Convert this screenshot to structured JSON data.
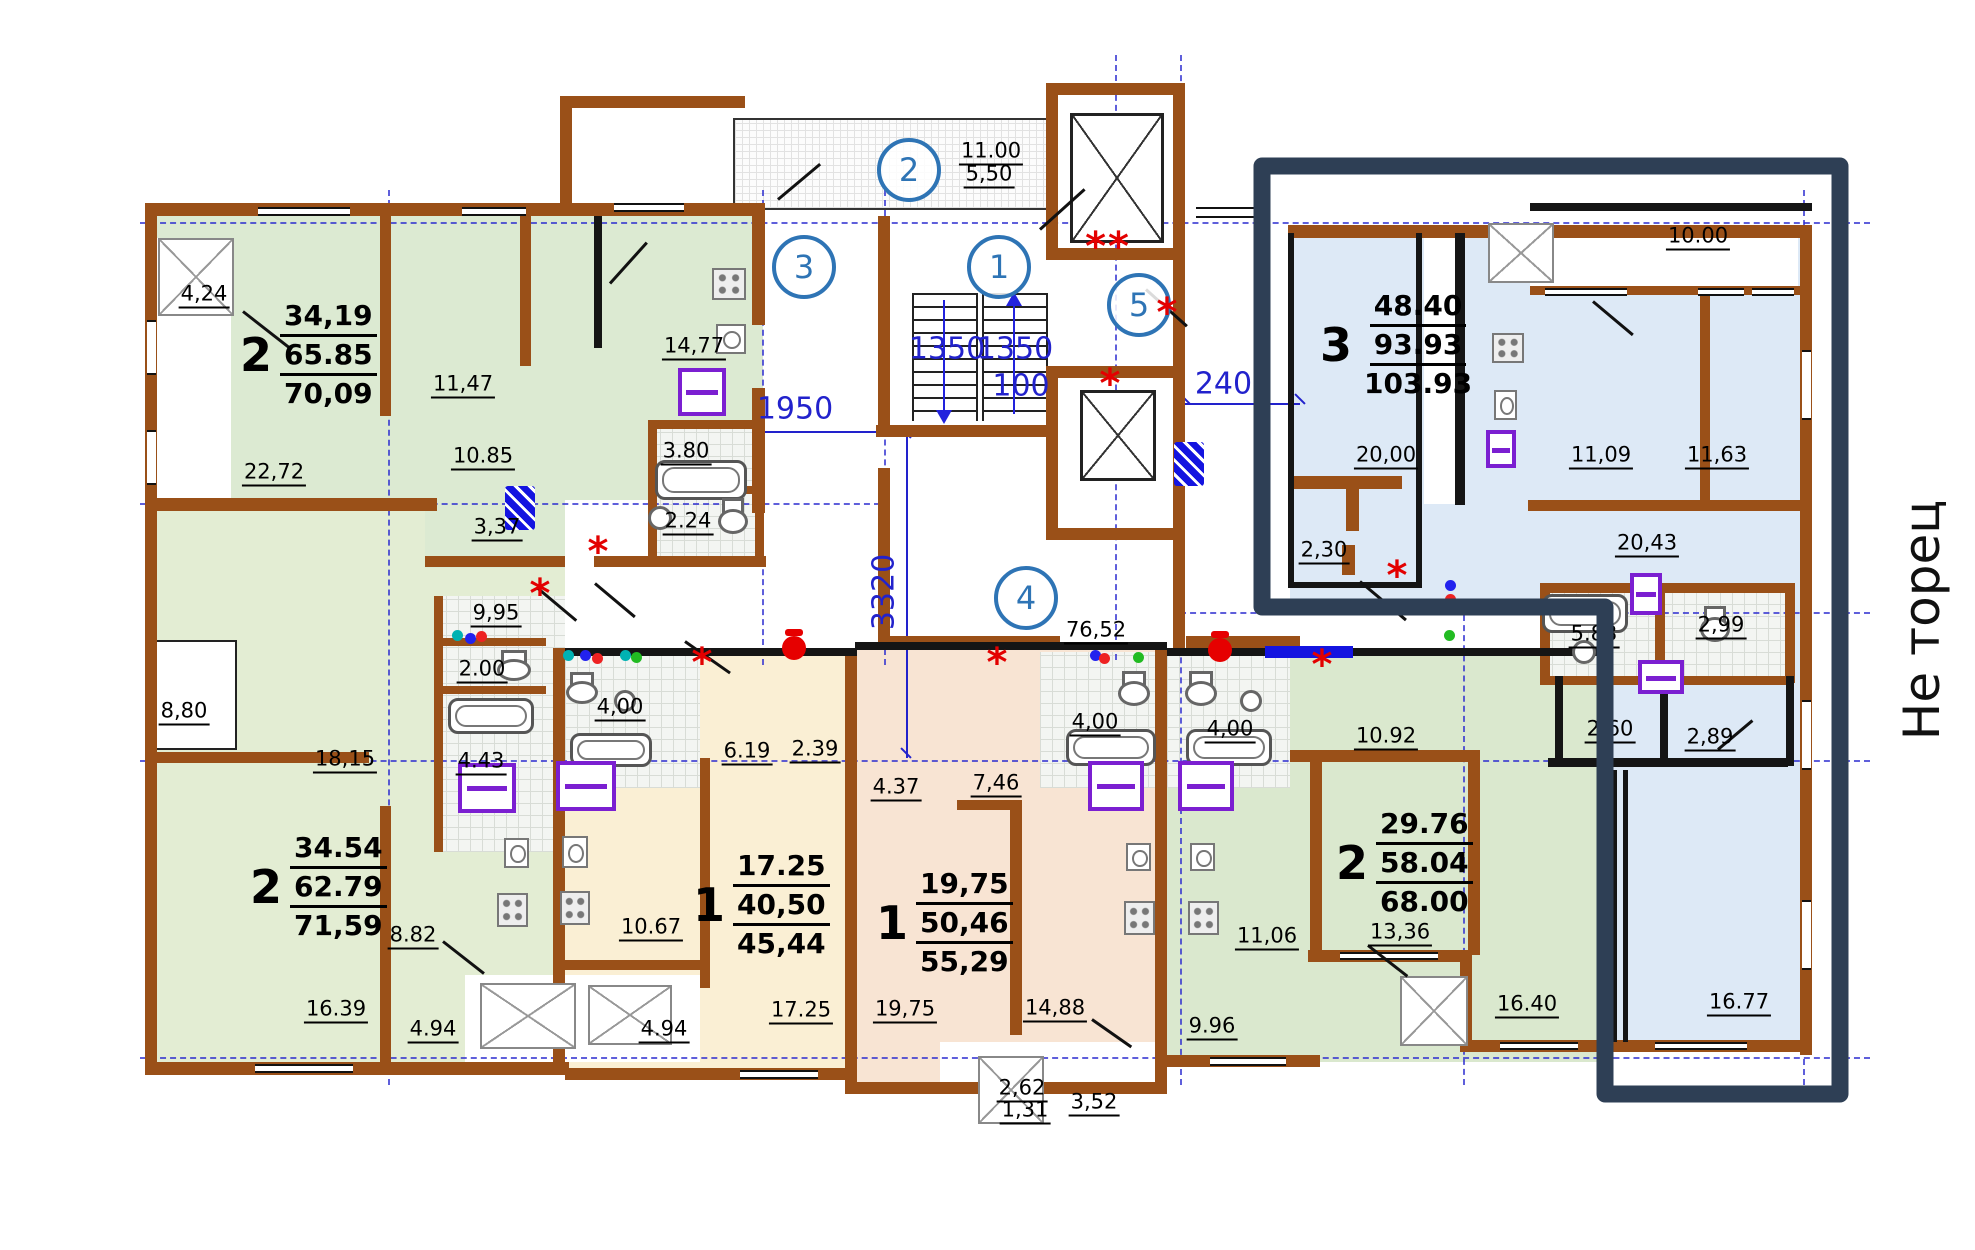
{
  "colors": {
    "wall": "#9a5018",
    "highlight": "#2e3f55",
    "dim_text": "#2222cc",
    "bubble": "#2e74b5",
    "asterisk": "#e30000"
  },
  "side_note": "Не торец",
  "axis_bubbles": [
    {
      "n": "2",
      "x": 909,
      "y": 170
    },
    {
      "n": "3",
      "x": 804,
      "y": 267
    },
    {
      "n": "1",
      "x": 999,
      "y": 267
    },
    {
      "n": "5",
      "x": 1139,
      "y": 305
    },
    {
      "n": "4",
      "x": 1026,
      "y": 598
    }
  ],
  "apartments": [
    {
      "type": "2",
      "areas": [
        "34,19",
        "65.85",
        "70,09"
      ],
      "x": 240,
      "y": 298
    },
    {
      "type": "2",
      "areas": [
        "34.54",
        "62.79",
        "71,59"
      ],
      "x": 250,
      "y": 830
    },
    {
      "type": "1",
      "areas": [
        "17.25",
        "40,50",
        "45,44"
      ],
      "x": 693,
      "y": 848
    },
    {
      "type": "1",
      "areas": [
        "19,75",
        "50,46",
        "55,29"
      ],
      "x": 876,
      "y": 866
    },
    {
      "type": "2",
      "areas": [
        "29.76",
        "58.04",
        "68.00"
      ],
      "x": 1336,
      "y": 806
    },
    {
      "type": "3",
      "areas": [
        "48.40",
        "93.93",
        "103.93"
      ],
      "x": 1320,
      "y": 288
    }
  ],
  "room_labels": [
    {
      "t": "4,24",
      "x": 204,
      "y": 295
    },
    {
      "t": "11,47",
      "x": 463,
      "y": 385
    },
    {
      "t": "22,72",
      "x": 274,
      "y": 473
    },
    {
      "t": "10.85",
      "x": 483,
      "y": 457
    },
    {
      "t": "14,77",
      "x": 694,
      "y": 347
    },
    {
      "t": "3.80",
      "x": 686,
      "y": 452
    },
    {
      "t": "2.24",
      "x": 688,
      "y": 522
    },
    {
      "t": "3,37",
      "x": 497,
      "y": 528
    },
    {
      "t": "8,80",
      "x": 184,
      "y": 712
    },
    {
      "t": "18,15",
      "x": 345,
      "y": 760
    },
    {
      "t": "9,95",
      "x": 496,
      "y": 614
    },
    {
      "t": "2.00",
      "x": 482,
      "y": 670
    },
    {
      "t": "4.43",
      "x": 481,
      "y": 762
    },
    {
      "t": "8.82",
      "x": 413,
      "y": 936
    },
    {
      "t": "16.39",
      "x": 336,
      "y": 1010
    },
    {
      "t": "4.94",
      "x": 433,
      "y": 1030
    },
    {
      "t": "4,00",
      "x": 620,
      "y": 708
    },
    {
      "t": "6.19",
      "x": 747,
      "y": 752
    },
    {
      "t": "2.39",
      "x": 815,
      "y": 750
    },
    {
      "t": "10.67",
      "x": 651,
      "y": 928
    },
    {
      "t": "17.25",
      "x": 801,
      "y": 1011
    },
    {
      "t": "4.94",
      "x": 664,
      "y": 1030
    },
    {
      "t": "4.37",
      "x": 896,
      "y": 788
    },
    {
      "t": "7,46",
      "x": 996,
      "y": 784
    },
    {
      "t": "4,00",
      "x": 1095,
      "y": 723
    },
    {
      "t": "19,75",
      "x": 905,
      "y": 1010
    },
    {
      "t": "14,88",
      "x": 1055,
      "y": 1009
    },
    {
      "t": "2,62",
      "x": 1022,
      "y": 1089
    },
    {
      "t": "1,31",
      "x": 1025,
      "y": 1111
    },
    {
      "t": "3,52",
      "x": 1094,
      "y": 1103
    },
    {
      "t": "9.96",
      "x": 1212,
      "y": 1027
    },
    {
      "t": "4,00",
      "x": 1230,
      "y": 730
    },
    {
      "t": "10.92",
      "x": 1386,
      "y": 737
    },
    {
      "t": "11,06",
      "x": 1267,
      "y": 937
    },
    {
      "t": "13,36",
      "x": 1400,
      "y": 933
    },
    {
      "t": "16.40",
      "x": 1527,
      "y": 1005
    },
    {
      "t": "20,00",
      "x": 1386,
      "y": 456
    },
    {
      "t": "2,30",
      "x": 1324,
      "y": 551
    },
    {
      "t": "11,09",
      "x": 1601,
      "y": 456
    },
    {
      "t": "11,63",
      "x": 1717,
      "y": 456
    },
    {
      "t": "20,43",
      "x": 1647,
      "y": 544
    },
    {
      "t": "5.83",
      "x": 1594,
      "y": 635
    },
    {
      "t": "2,99",
      "x": 1721,
      "y": 626
    },
    {
      "t": "2,60",
      "x": 1610,
      "y": 730
    },
    {
      "t": "2,89",
      "x": 1710,
      "y": 738
    },
    {
      "t": "16.77",
      "x": 1739,
      "y": 1003
    },
    {
      "t": "10.00",
      "x": 1698,
      "y": 237
    },
    {
      "t": "76,52",
      "x": 1096,
      "y": 631
    },
    {
      "t": "11.00",
      "x": 991,
      "y": 152
    },
    {
      "t": "5,50",
      "x": 989,
      "y": 175
    }
  ],
  "dim_labels": [
    {
      "t": "1950",
      "x": 795,
      "y": 409,
      "rot": 0
    },
    {
      "t": "1350",
      "x": 947,
      "y": 349,
      "rot": 0
    },
    {
      "t": "1350",
      "x": 1015,
      "y": 349,
      "rot": 0
    },
    {
      "t": "100",
      "x": 1021,
      "y": 386,
      "rot": 0
    },
    {
      "t": "2400",
      "x": 1233,
      "y": 384,
      "rot": 0
    },
    {
      "t": "3320",
      "x": 884,
      "y": 592,
      "rot": -90
    }
  ],
  "asterisks": [
    {
      "t": "**",
      "x": 1108,
      "y": 247
    },
    {
      "t": "*",
      "x": 1168,
      "y": 313
    },
    {
      "t": "*",
      "x": 1111,
      "y": 384
    },
    {
      "t": "*",
      "x": 1398,
      "y": 576
    },
    {
      "t": "*",
      "x": 599,
      "y": 552
    },
    {
      "t": "*",
      "x": 541,
      "y": 594
    },
    {
      "t": "*",
      "x": 703,
      "y": 663
    },
    {
      "t": "*",
      "x": 998,
      "y": 663
    },
    {
      "t": "*",
      "x": 1323,
      "y": 665
    }
  ]
}
